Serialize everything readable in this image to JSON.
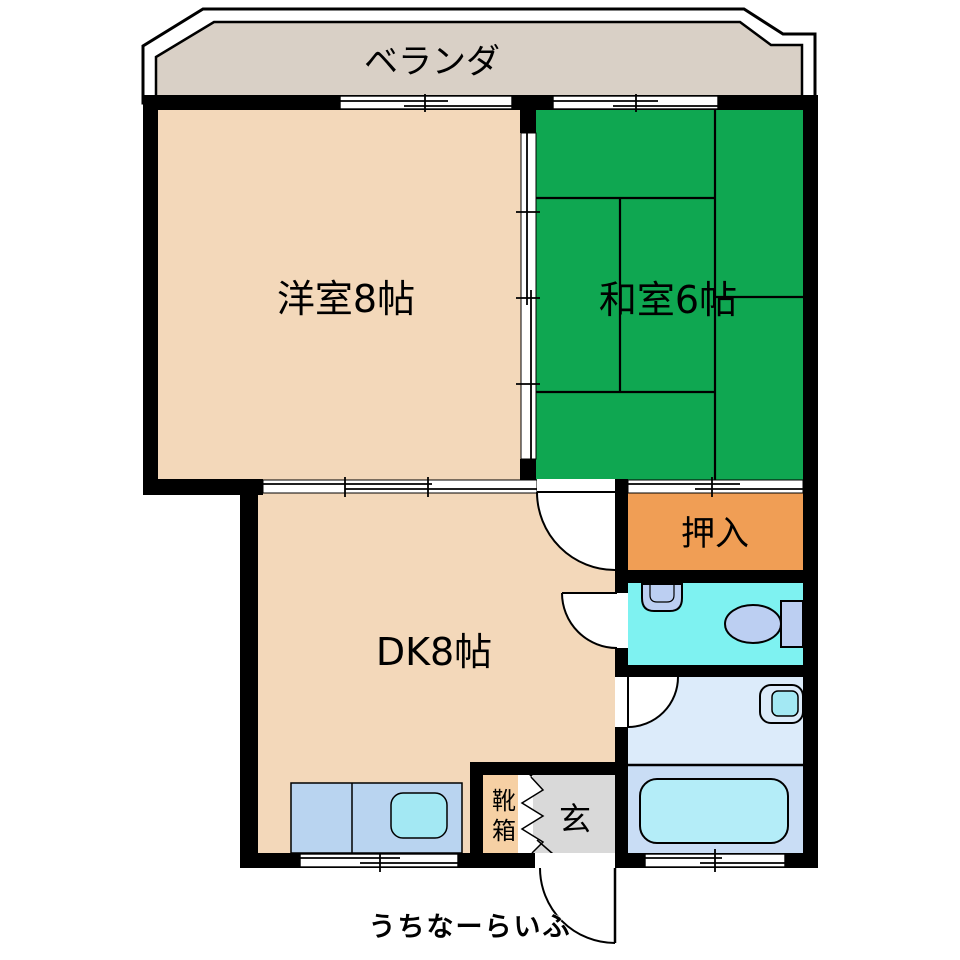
{
  "labels": {
    "veranda": "ベランダ",
    "western_room": "洋室8帖",
    "japanese_room": "和室6帖",
    "closet": "押入",
    "dining_kitchen": "DK8帖",
    "shoe_box_top": "靴",
    "shoe_box_bottom": "箱",
    "entrance": "玄"
  },
  "watermark": "うちなーらいふ",
  "colors": {
    "wall": "#000000",
    "veranda_floor": "#d9d0c6",
    "western_room_floor": "#f3d8ba",
    "japanese_room_floor": "#0fa751",
    "closet_fill": "#f09e55",
    "toilet_room_fill": "#7ef2f1",
    "washroom_fill": "#dcebfa",
    "bath_fill": "#c9ddf5",
    "entrance_floor": "#d9d9d9",
    "shoe_box_fill": "#f6d0a4",
    "fixture_fill": "#bccff2",
    "bathtub_fill": "#b4edf8",
    "counter_fill": "#b9d4f0",
    "kitchen_sink_fill": "#a3e8f3",
    "watermark_color": "#c9c9c9"
  }
}
